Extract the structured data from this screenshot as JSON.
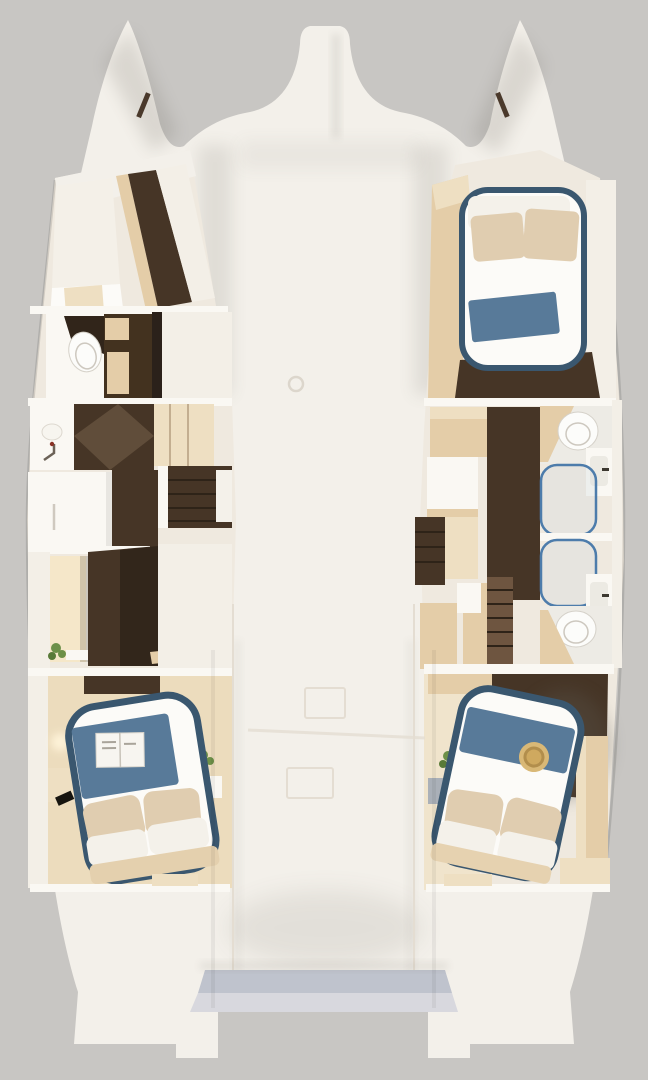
{
  "scene": {
    "description": "Top-down cutaway 3D rendering of a catamaran yacht interior layout with four cabins, two hulls, central deck and transom steps",
    "view": "overhead floorplan render",
    "text_visible": "none"
  },
  "areas": [
    {
      "id": "port-forward-cabin",
      "desc": "V-berth cabin in port bow with white berth and wood corridor"
    },
    {
      "id": "port-bathroom",
      "desc": "Port head with toilet, white counter and beige cabinet"
    },
    {
      "id": "port-vanity-corridor",
      "desc": "Vanity with sink and faucet, wood corridor, companionway stairs"
    },
    {
      "id": "port-wardrobe-closet",
      "desc": "White dresser and lit closet with plant and shelf"
    },
    {
      "id": "port-aft-cabin",
      "desc": "Aft double cabin, island bed with navy trim, blue blanket, open magazine, pillows, plant, lamp"
    },
    {
      "id": "starboard-forward-cabin",
      "desc": "Forward double cabin, bed with navy piping, beige pillows, folded blue blanket"
    },
    {
      "id": "starboard-bathrooms",
      "desc": "Twin heads with toilets, twin showers with blue-framed glass, twin sinks"
    },
    {
      "id": "starboard-aft-cabin",
      "desc": "Aft double cabin, island bed with blue runner and straw hat, pillows, plant"
    },
    {
      "id": "foredeck",
      "desc": "White foredeck with central bow nacelle and bow fairleads"
    },
    {
      "id": "aft-deck",
      "desc": "Cockpit deck with hatch outlines and deck vent"
    },
    {
      "id": "stern-steps",
      "desc": "Blue-grey transom steps between the hull sterns"
    }
  ],
  "palette": {
    "background": "#c8c6c3",
    "hull": "#f3f0ea",
    "wall_white": "#f3efe7",
    "white_soft": "#faf8f3",
    "floor_cream": "#efe9df",
    "mattress": "#fcfbf8",
    "wall_beige": "#e4cda8",
    "beige_light": "#eedfc2",
    "wood_dark": "#463526",
    "wood_mid": "#6e5540",
    "blanket_blue": "#587a99",
    "trim_navy": "#3a576f",
    "glass_blue": "#4d7cab",
    "pillow_beige": "#e0cdb0",
    "pillow_white": "#f4f1ea",
    "toilet": "#fcfcfa",
    "plant_green": "#6d9048",
    "straw_hat": "#d9b876",
    "straw_hat_dark": "#b28e4c",
    "steps_blue": "#bfc3cd",
    "steps_blue_light": "#d8d8de",
    "deck_line": "#e4ddd2",
    "warm_glow": "#f5e7c9",
    "fairlead_dark": "#4a392b",
    "faucet_red": "#8a3326"
  }
}
